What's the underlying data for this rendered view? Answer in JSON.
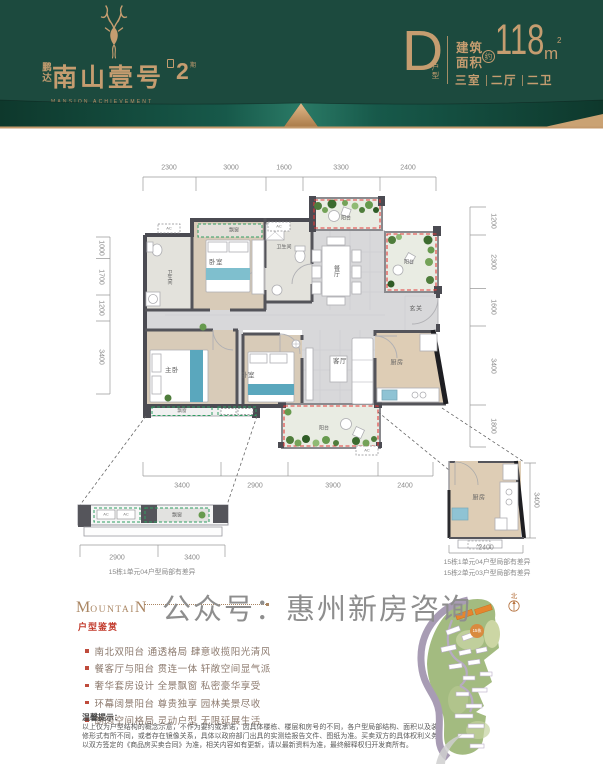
{
  "header": {
    "brand_prefix": "鹏达",
    "brand_name": "南山壹号",
    "brand_phase_num": "2",
    "brand_phase_suffix": "期",
    "brand_tagline": "MANSION ACHIEVEMENT",
    "unit_letter": "D",
    "unit_suffix": "户型",
    "area_label": "建筑 面积",
    "area_label_line1": "建筑",
    "area_label_line2": "面积",
    "area_approx": "约",
    "area_value": "118",
    "area_unit": "m",
    "area_unit_sup": "2",
    "spec_parts": [
      "三室",
      "二厅",
      "二卫"
    ]
  },
  "plan": {
    "dims_top": [
      "2300",
      "3000",
      "1600",
      "3300",
      "2400"
    ],
    "dims_left": [
      "1000",
      "1700",
      "1200",
      "3400"
    ],
    "dims_right": [
      "1200",
      "2300",
      "1600",
      "3400",
      "1800"
    ],
    "dims_bottom": [
      "3400",
      "2900",
      "3900",
      "2400"
    ],
    "rooms": {
      "bay_window": "飘窗",
      "bedroom_top": "卧室",
      "bathroom_top": "卫生间",
      "bathroom_left": "卫生间",
      "balcony_top": "阳台",
      "balcony_right": "阳台",
      "dining": "餐厅",
      "entry": "玄关",
      "master_bedroom": "主卧",
      "bedroom_2": "卧室",
      "living": "客厅",
      "kitchen": "厨房",
      "balcony_bottom": "阳台",
      "bay_window_bottom": "飘窗",
      "ac_label": "AC"
    },
    "detail_left": {
      "bay_label": "飘窗",
      "dims": [
        "2900",
        "3400"
      ],
      "caption": "15栋1单元04户型局部有差异"
    },
    "detail_right": {
      "room": "厨房",
      "dim_bottom": "2400",
      "dim_side": "3400",
      "captions": [
        "15栋1单元04户型局部有差异",
        "15栋2单元03户型局部有差异"
      ]
    }
  },
  "watermark": "公众号：惠州新房咨询",
  "features": {
    "title_m": "M",
    "title_mid": "OUNTAI",
    "title_n": "N",
    "subtitle": "户型鉴赏",
    "items": [
      "南北双阳台 通透格局 肆意收揽阳光清风",
      "餐客厅与阳台 贯连一体 轩敞空间显气派",
      "奢华套房设计 全景飘窗 私密豪华享受",
      "环幕阔景阳台 尊贵独享 园林美景尽收",
      "朗阔空间格局 灵动户型 无限延展生活"
    ]
  },
  "siteplan": {
    "north_label": "北",
    "building_badge": "15栋"
  },
  "disclaimer": {
    "title": "温馨提示：",
    "body": "以上仅为户型结构的概念示意，不作为要约或承诺，因具体楼栋、楼层和房号的不同，各户型局部结构、面积以及装修形式有所不同，或者存在镜像关系，具体以政府部门出具的实测绘报告文件、图纸为准。买卖双方的具体权利义务以双方签定的《商品房买卖合同》为准，相关内容如有更新，请以最新资料为准，最终解释权归开发商所有。"
  },
  "colors": {
    "header_green": "#1c4a3e",
    "gold": "#c59d70",
    "red_dash": "#e23b3b",
    "green_dash": "#2f9e62",
    "accent_red": "#c23a2c"
  }
}
